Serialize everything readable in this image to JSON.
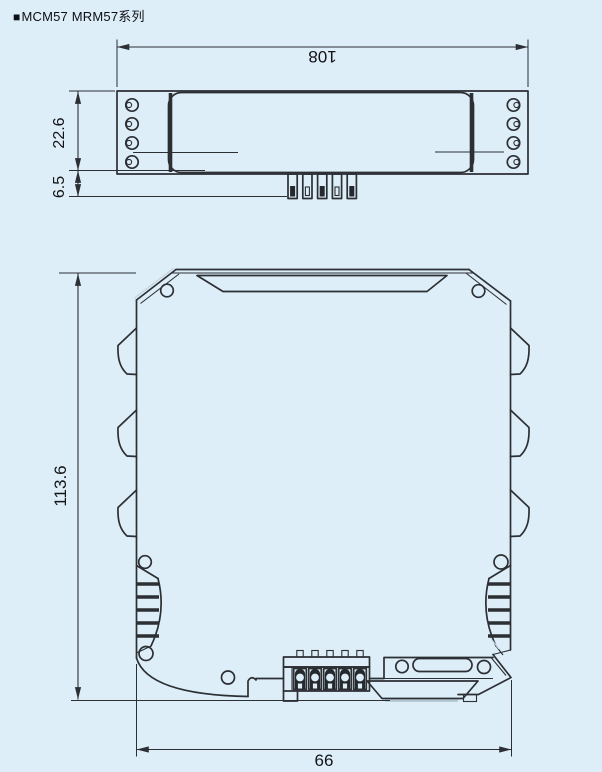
{
  "page": {
    "background_color": "#ddeef8",
    "line_color": "#2c2f33",
    "description": "Technical dimensional drawing, top view and front view of DIN-rail module"
  },
  "title": {
    "marker": "■",
    "text": "MCM57 MRM57系列"
  },
  "top_view": {
    "dimensions": {
      "length": "108",
      "body_width": "22.6",
      "pin_depth": "6.5"
    }
  },
  "front_view": {
    "dimensions": {
      "height": "113.6",
      "width": "66"
    }
  }
}
